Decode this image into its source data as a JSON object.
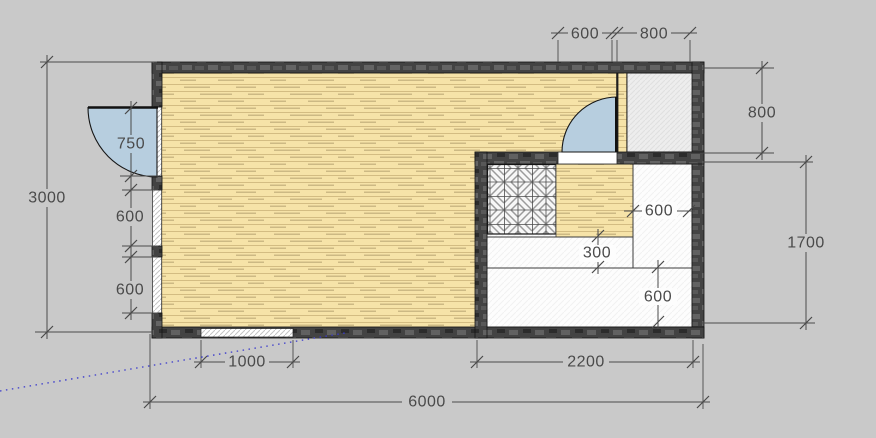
{
  "drawing": {
    "type": "architectural floor plan, top view"
  },
  "dimensions": {
    "top_door_width": "600",
    "top_closet_width": "800",
    "closet_height": "800",
    "left_total_height": "3000",
    "left_door_width": "750",
    "left_window_upper": "600",
    "left_window_lower": "600",
    "bottom_window_width": "1000",
    "right_room_width": "2200",
    "total_width": "6000",
    "right_room_height": "1700",
    "counter_right_width": "600",
    "counter_step_depth": "300",
    "counter_bottom_depth": "600"
  },
  "colors": {
    "background": "#c9c9c9",
    "wood_floor": "#f6e3a8",
    "wall_dark": "#434343",
    "door_swing": "#b7cedf",
    "closet_floor": "#ededed",
    "white_floor": "#fdfdfd",
    "dimension_ink": "#4a4a4a",
    "guide_line": "#3a3acc"
  }
}
